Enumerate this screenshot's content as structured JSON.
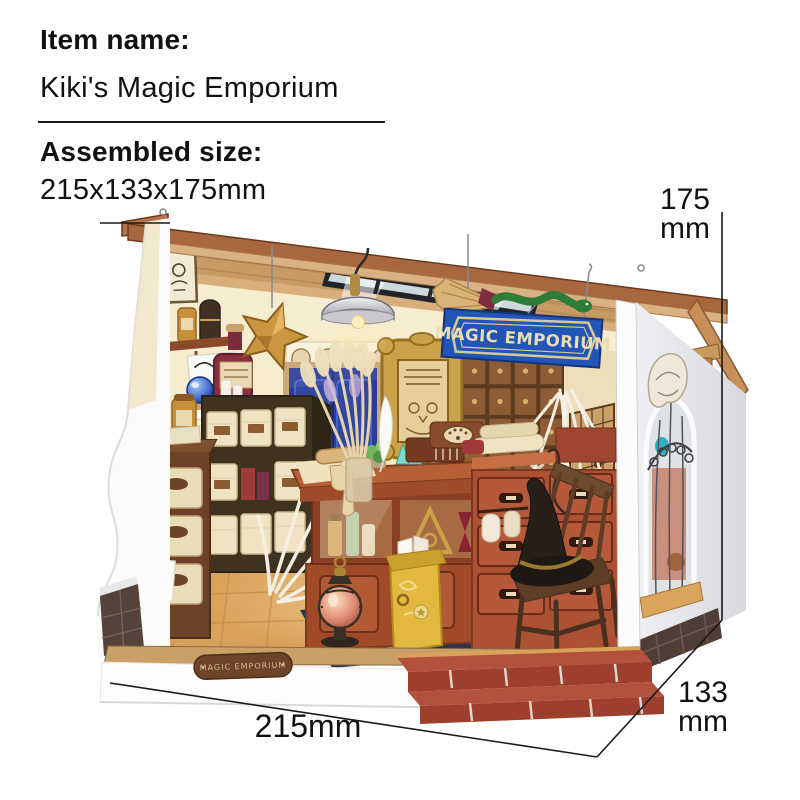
{
  "header": {
    "item_name_label": "Item name:",
    "item_name_value": "Kiki's Magic Emporium",
    "assembled_size_label": "Assembled size:",
    "assembled_size_value": "215x133x175mm"
  },
  "dimensions": {
    "height": {
      "value": "175",
      "unit": "mm"
    },
    "depth": {
      "value": "133",
      "unit": "mm"
    },
    "width": {
      "value": "215mm"
    }
  },
  "product": {
    "name": "Kiki's Magic Emporium miniature dollhouse",
    "sign_text": "MAGIC EMPORIUM",
    "base_plaque_text": "MAGIC EMPORIUM",
    "colors": {
      "sign_blue": "#2156b8",
      "roof_brown": "#a9673f",
      "door_blue": "#2b3c99",
      "mailbox_yellow": "#e2b93e",
      "brick_red": "#a84534",
      "gold": "#c9a24a",
      "wall_cream": "#f6ecd0",
      "floor_wood": "#d9a25c"
    }
  }
}
